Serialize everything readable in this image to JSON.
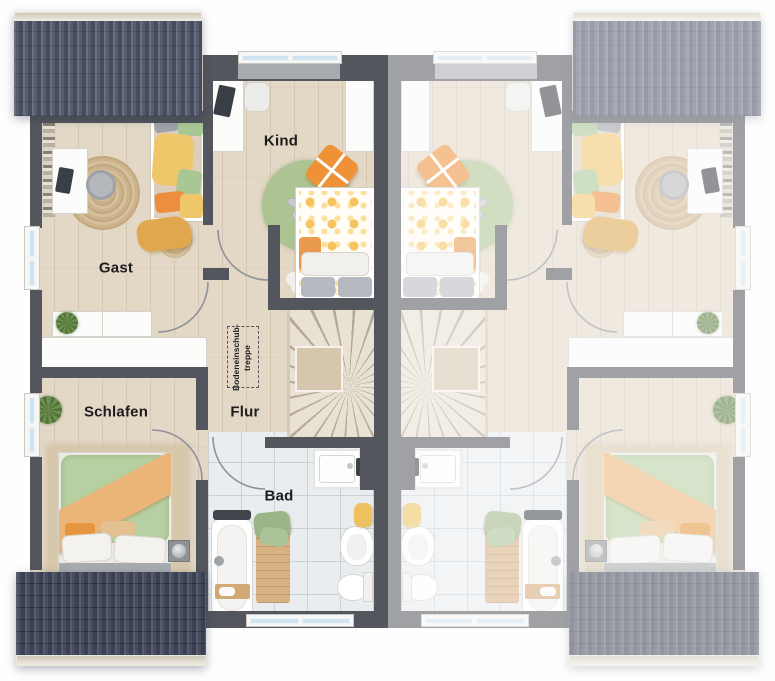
{
  "floorplan": {
    "unit_left": {
      "rooms": {
        "gast": {
          "label": "Gast"
        },
        "kind": {
          "label": "Kind"
        },
        "schlafen": {
          "label": "Schlafen"
        },
        "flur": {
          "label": "Flur"
        },
        "bad": {
          "label": "Bad"
        }
      },
      "attic_hatch": {
        "line1": "Bodeneinschub-",
        "line2": "treppe"
      }
    },
    "unit_right": {
      "mirrored": true,
      "labels_visible": false
    },
    "colors": {
      "roof_dark": "#555b6c",
      "roof_dark_lower": "#464c5d",
      "wall": "#53565c",
      "wall_faded": "#a5a9ae",
      "floor_wood": "#e3d8c6",
      "bathroom_tile": "#eaedef",
      "window_glass": "#cfe3f0",
      "accent_green": "#aec695",
      "accent_orange": "#ee9140",
      "accent_yellow": "#f2c76d",
      "rug_jute": "#cdb38c"
    }
  }
}
